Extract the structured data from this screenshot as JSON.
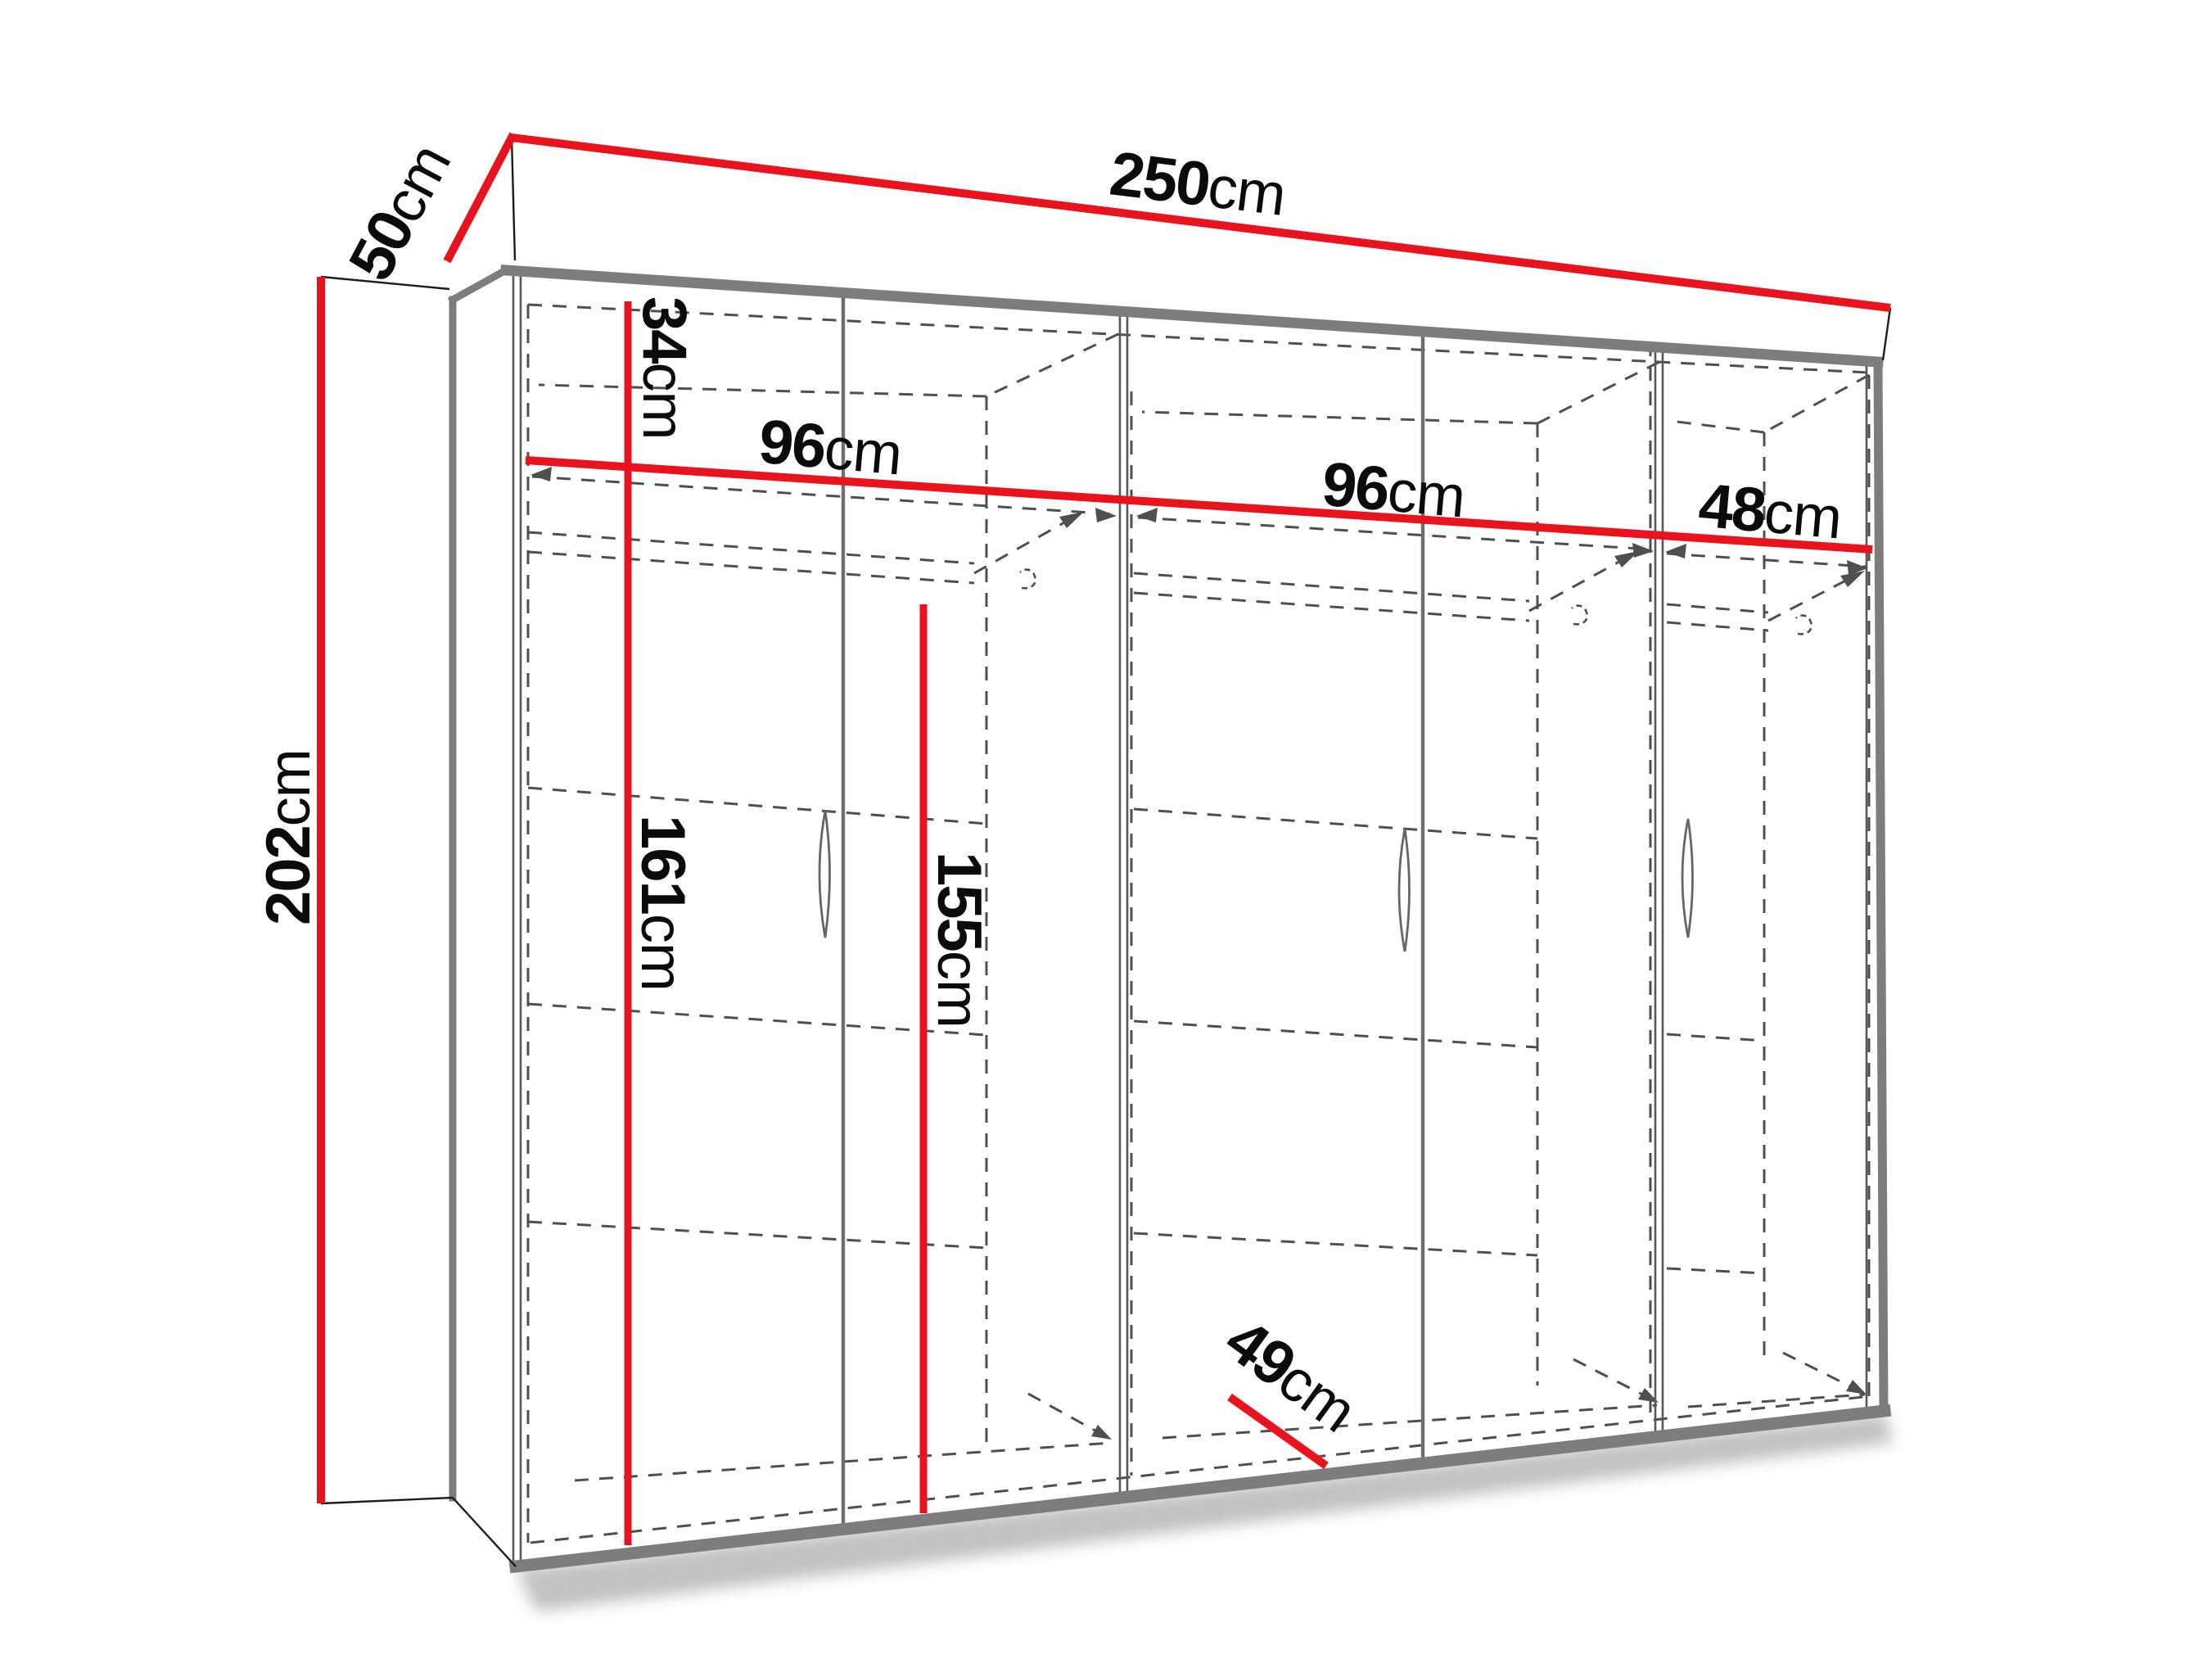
{
  "diagram": {
    "type": "wardrobe-dimension-drawing",
    "unit": "cm",
    "labels": {
      "width": {
        "num": "250",
        "unit": "cm"
      },
      "depth": {
        "num": "50",
        "unit": "cm"
      },
      "height": {
        "num": "202",
        "unit": "cm"
      },
      "top_compartment": {
        "num": "34",
        "unit": "cm"
      },
      "section_left": {
        "num": "96",
        "unit": "cm"
      },
      "section_middle": {
        "num": "96",
        "unit": "cm"
      },
      "section_right": {
        "num": "48",
        "unit": "cm"
      },
      "lower_height": {
        "num": "161",
        "unit": "cm"
      },
      "rail_height": {
        "num": "155",
        "unit": "cm"
      },
      "inner_depth": {
        "num": "49",
        "unit": "cm"
      }
    },
    "colors": {
      "dimension_line": "#e8131d",
      "carcass_edge": "#7d7d7d",
      "hidden_line": "#4f4f4f",
      "label_text": "#0b0b0b",
      "background": "#ffffff"
    }
  }
}
